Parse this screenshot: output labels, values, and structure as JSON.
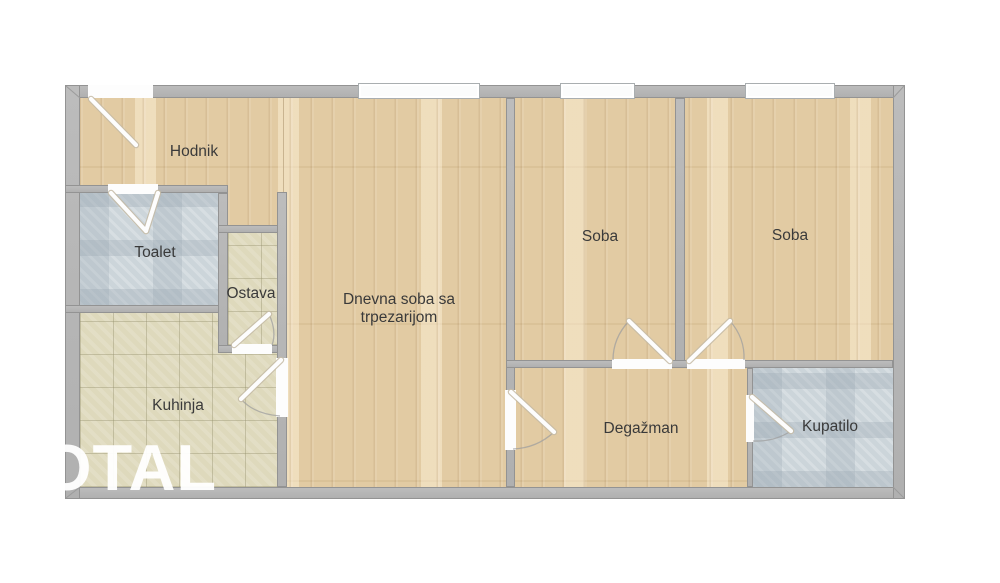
{
  "plan": {
    "type": "apartment-floor-plan",
    "watermark": {
      "text": "OTAL"
    },
    "rooms": {
      "hodnik": {
        "label": "Hodnik"
      },
      "toalet": {
        "label": "Toalet"
      },
      "ostava": {
        "label": "Ostava"
      },
      "kuhinja": {
        "label": "Kuhinja"
      },
      "dnevna": {
        "label": "Dnevna soba sa trpezarijom"
      },
      "soba1": {
        "label": "Soba"
      },
      "soba2": {
        "label": "Soba"
      },
      "degazman": {
        "label": "Degažman"
      },
      "kupatilo": {
        "label": "Kupatilo"
      }
    },
    "colors": {
      "wall": "#b6b6b6",
      "wall_edge": "#939393",
      "wood_floor": "#e2cba3",
      "tile_beige": "#ded9bc",
      "tile_blue": "#ccd5da",
      "label_text": "#3a3a3a",
      "watermark": "#ffffff",
      "background": "#ffffff"
    },
    "features": {
      "windows": 3,
      "doors": [
        "entry-door",
        "toalet-door",
        "ostava-door",
        "kuhinja-door",
        "degazman-door",
        "soba1-door",
        "soba2-door",
        "kupatilo-door"
      ]
    }
  }
}
